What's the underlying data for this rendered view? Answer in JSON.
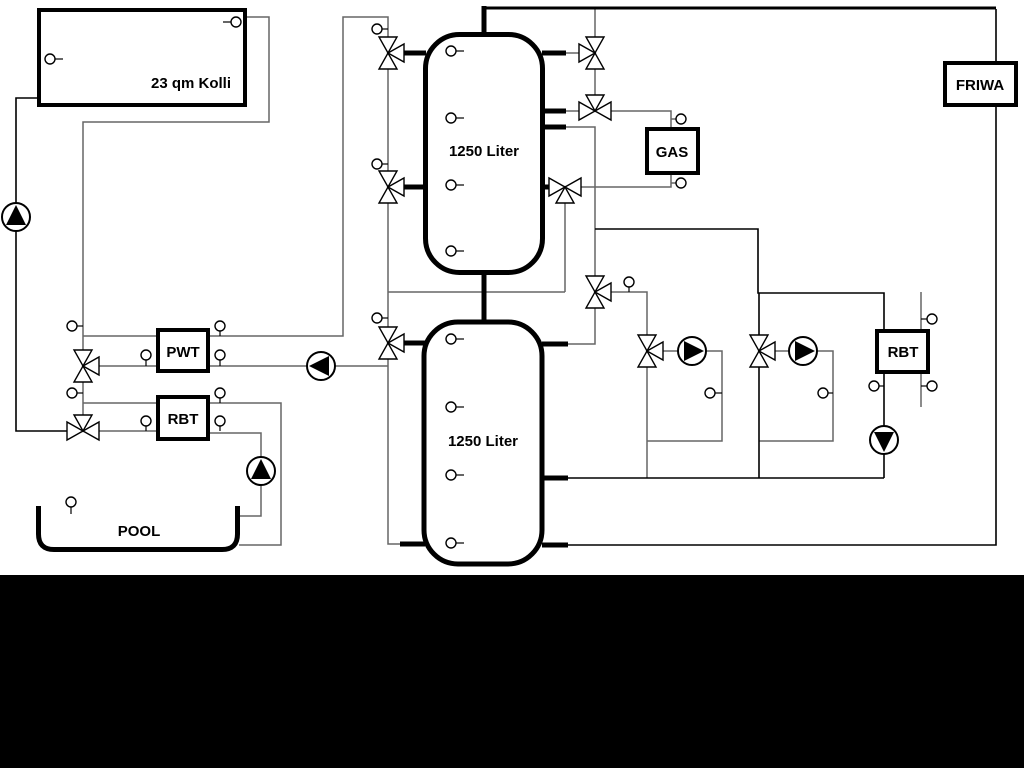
{
  "diagram": {
    "type": "hydraulic-heating-schematic",
    "labels": {
      "collector": "23 qm Kolli",
      "tank_top": "1250 Liter",
      "tank_bottom": "1250 Liter",
      "pwt": "PWT",
      "rbt_left": "RBT",
      "rbt_right": "RBT",
      "gas": "GAS",
      "friwa": "FRIWA",
      "pool": "POOL"
    },
    "colors": {
      "background": "#ffffff",
      "line": "#666666",
      "line_dark": "#000000",
      "bottom_band": "#000000"
    },
    "summary": {
      "buffer_tanks": 2,
      "tank_capacity": "1250 Liter",
      "pumps": 6,
      "three_way_valves": 11,
      "temperature_sensors": 30
    }
  }
}
